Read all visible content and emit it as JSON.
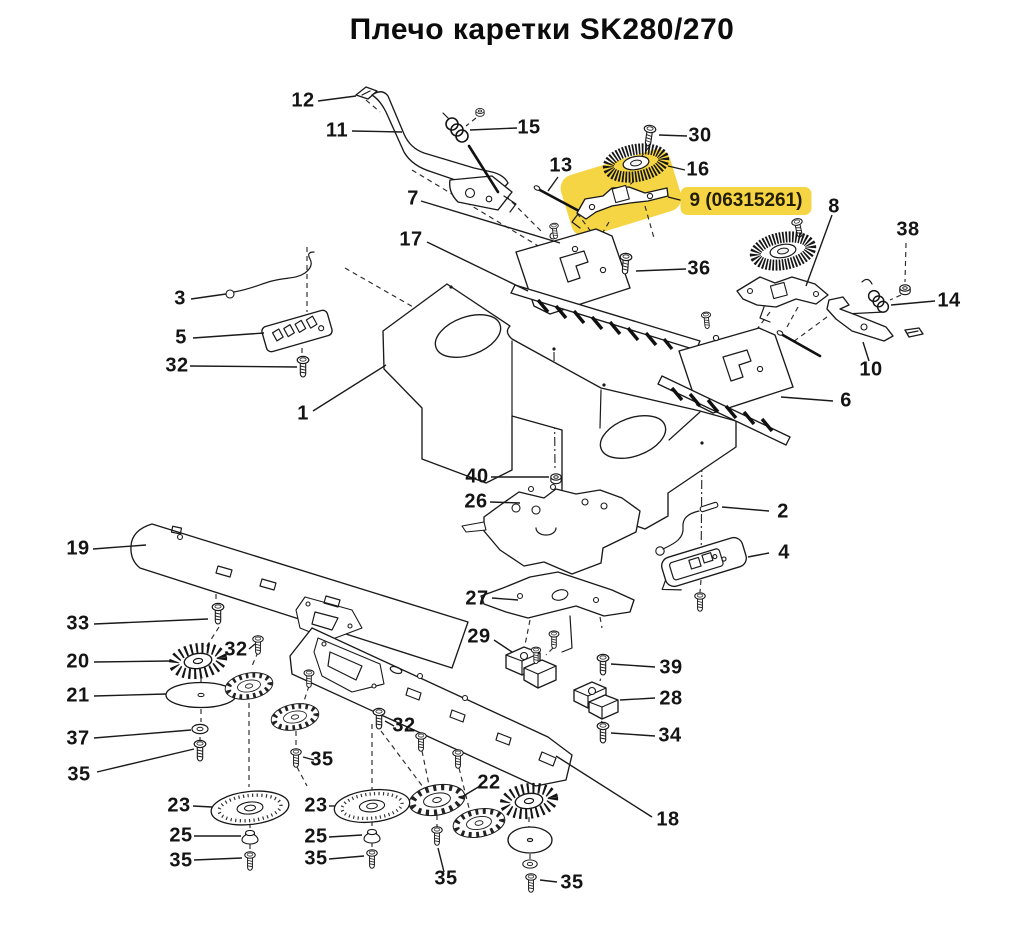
{
  "title": "Плечо каретки SK280/270",
  "highlight": {
    "label": "9 (06315261)",
    "color": "#f6d544"
  },
  "callouts": {
    "p1": "1",
    "p2": "2",
    "p3": "3",
    "p4": "4",
    "p5": "5",
    "p6": "6",
    "p7": "7",
    "p8": "8",
    "p9": "9 (06315261)",
    "p10": "10",
    "p11": "11",
    "p12": "12",
    "p13": "13",
    "p14": "14",
    "p15": "15",
    "p16": "16",
    "p17": "17",
    "p18": "18",
    "p19": "19",
    "p20": "20",
    "p21": "21",
    "p22": "22",
    "p23a": "23",
    "p23b": "23",
    "p25a": "25",
    "p25b": "25",
    "p26": "26",
    "p27": "27",
    "p28": "28",
    "p29": "29",
    "p30": "30",
    "p32a": "32",
    "p32b": "32",
    "p32c": "32",
    "p33": "33",
    "p34": "34",
    "p35a": "35",
    "p35b": "35",
    "p35c": "35",
    "p35d": "35",
    "p35e": "35",
    "p35f": "35",
    "p36": "36",
    "p37": "37",
    "p38": "38",
    "p39": "39",
    "p40": "40"
  }
}
